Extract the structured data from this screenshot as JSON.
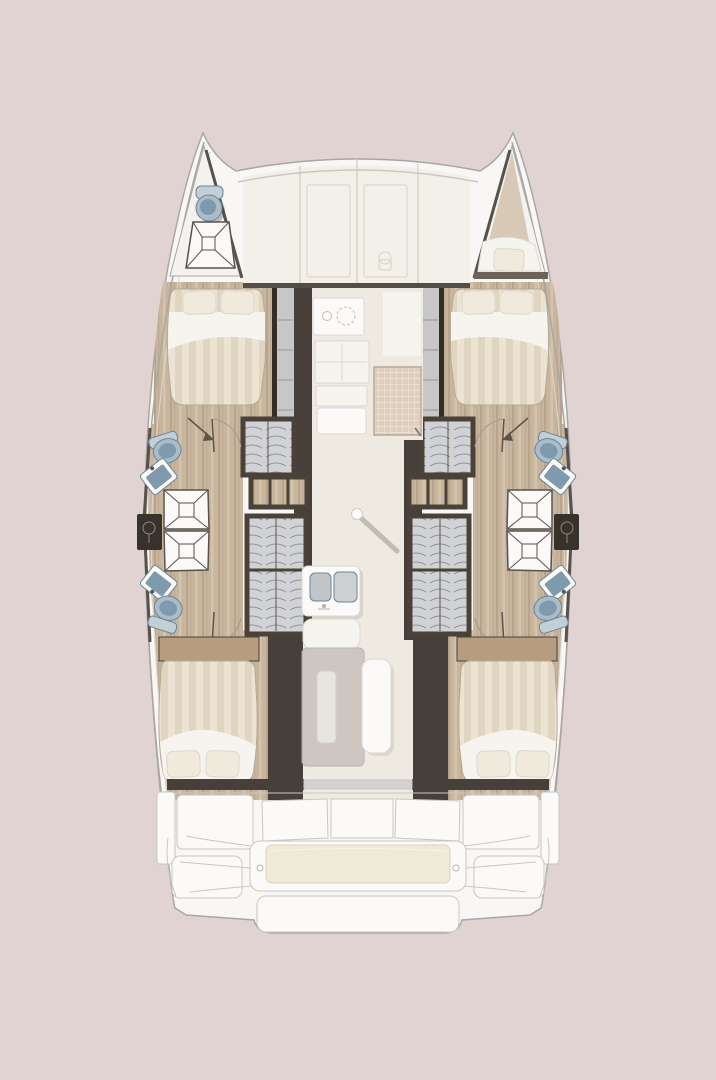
{
  "scene": {
    "description": "Top-down interior floor plan of a sailing catamaran (two hulls, central saloon). No text labels are rendered in the image.",
    "view": "plan view, bows at top, stern at bottom"
  },
  "colors": {
    "background": "#e1d3d2",
    "hull": "#f8f7f5",
    "hull_outline": "#a9a7a3",
    "bow_floor": "#f3f2ef",
    "deck_panel": "#f3f0e9",
    "panel_line": "#d8d2c4",
    "wood_floor": "#c8b59e",
    "wood_dark": "#b69d80",
    "wall_dark": "#47403a",
    "wall_edge": "#332e29",
    "wall_stroke": "#57524c",
    "corridor": "#c8c7c7",
    "saloon_floor": "#efeae1",
    "duvet_light": "#ece3d3",
    "duvet_dark": "#e0d5c1",
    "linen": "#f7f5f0",
    "pillow": "#f0eadc",
    "fixture_blue": "#a9bcc9",
    "fixture_basin": "#7f9aac",
    "fixture_blue_dark": "#6e8596",
    "wardrobe_gray": "#d0d2d5",
    "frame_dark": "#4a4138",
    "cabinet_dark": "#38322c",
    "mat_tan": "#e0cfbe",
    "bench_cushion": "#efe9d7",
    "table": "#cdc6c0",
    "bow_wedge": "#d8c9b6"
  },
  "rooms": [
    {
      "id": "bow-head",
      "name": "forward head in port bow (toilet + shower pan)"
    },
    {
      "id": "bow-berth",
      "name": "forepeak berth in starboard bow (single mattress + pillow)"
    },
    {
      "id": "foredeck-lockers",
      "name": "forward deck panel with two hatch doors"
    },
    {
      "id": "port-forward-cabin",
      "name": "double cabin, pillows forward"
    },
    {
      "id": "starboard-forward-cabin",
      "name": "double cabin, pillows forward"
    },
    {
      "id": "port-bathrooms",
      "name": "two back-to-back heads: toilet, angled sink, shower with X drain each"
    },
    {
      "id": "starboard-bathrooms",
      "name": "two back-to-back heads: toilet, angled sink, shower with X drain each"
    },
    {
      "id": "galley",
      "name": "centre-forward galley: cooktop with burners, drawer counters, grid floor mat"
    },
    {
      "id": "saloon",
      "name": "central saloon: double-basin sink island, table with inset, bench seat, ceiling light ball"
    },
    {
      "id": "port-aft-cabin",
      "name": "double cabin, pillows aft"
    },
    {
      "id": "starboard-aft-cabin",
      "name": "double cabin, pillows aft"
    },
    {
      "id": "cockpit",
      "name": "aft cockpit: three seat-back panels, bench with cream cushion, swim platform steps"
    }
  ],
  "fixture_counts": {
    "double_beds": 4,
    "bow_berths": 1,
    "toilets": 5,
    "sinks_bathroom": 4,
    "showers": 5,
    "wardrobes_per_hull": 2,
    "shelf_units_per_hull": 1,
    "galley_basins": 2
  }
}
